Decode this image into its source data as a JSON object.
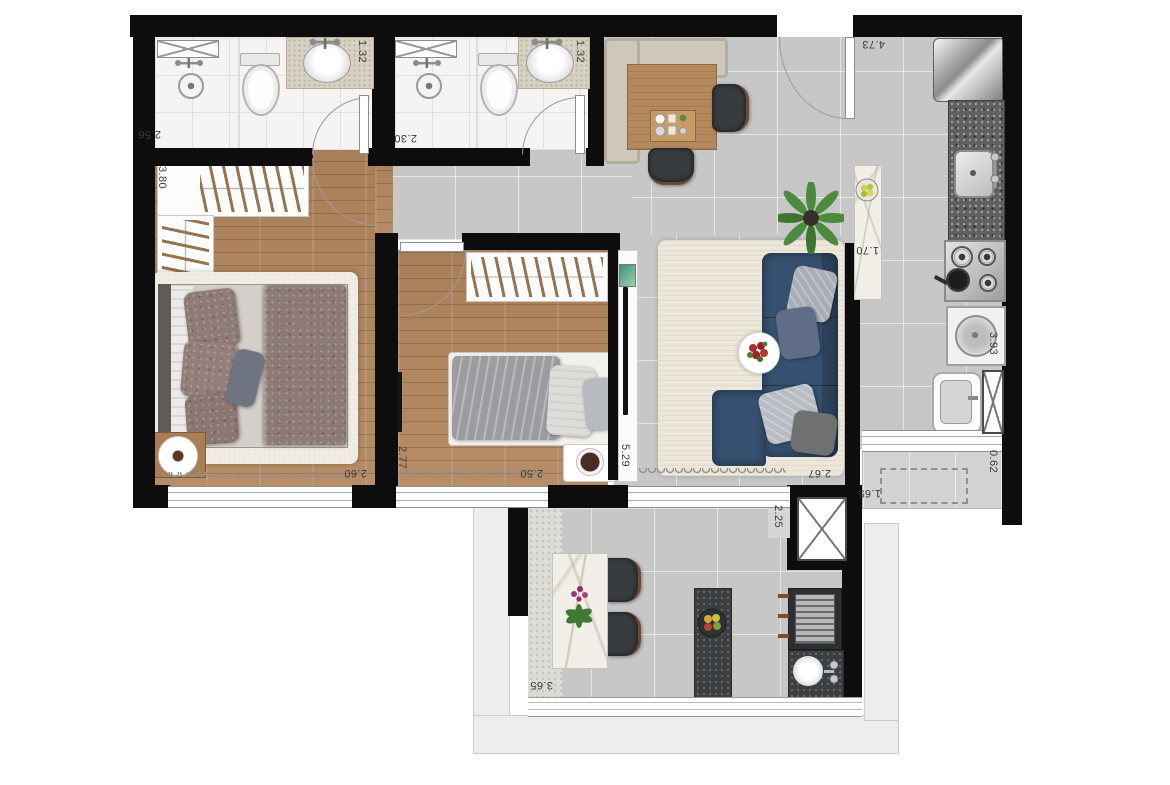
{
  "dimensions": [
    {
      "id": "bath1-width",
      "text": "1.32"
    },
    {
      "id": "bath1-depth",
      "text": "2.56"
    },
    {
      "id": "bath2-width",
      "text": "1.32"
    },
    {
      "id": "bath2-depth",
      "text": "2.30"
    },
    {
      "id": "entry-hall-length",
      "text": "4.73"
    },
    {
      "id": "bedroom1-depth",
      "text": "3.80"
    },
    {
      "id": "island-length",
      "text": "1.70"
    },
    {
      "id": "kitchen-run",
      "text": "3.93"
    },
    {
      "id": "bedroom1-width",
      "text": "2.60"
    },
    {
      "id": "bedroom2-depth",
      "text": "2.77"
    },
    {
      "id": "bedroom2-width",
      "text": "2.50"
    },
    {
      "id": "living-length",
      "text": "5.29"
    },
    {
      "id": "living-width",
      "text": "2.67"
    },
    {
      "id": "service-ledge-depth",
      "text": "0.62"
    },
    {
      "id": "service-ledge-width",
      "text": "1.65"
    },
    {
      "id": "duct-width",
      "text": "2.25"
    },
    {
      "id": "balcony-width",
      "text": "3.65"
    }
  ],
  "colors": {
    "wall": "#0d0d0d",
    "wood_floor": "#b3875f",
    "gray_tile": "#c7c7c7",
    "bath_tile": "#f5f4f2",
    "sofa_blue": "#36506f",
    "rug_cream": "#ece7d9",
    "granite_dark": "#606060",
    "balcony_stone": "#3c3f42",
    "vanity_quartz": "#d8d2c2",
    "marble": "#f1efe8",
    "plant_green": "#4c8a3d",
    "flower_red": "#a82f2f"
  }
}
